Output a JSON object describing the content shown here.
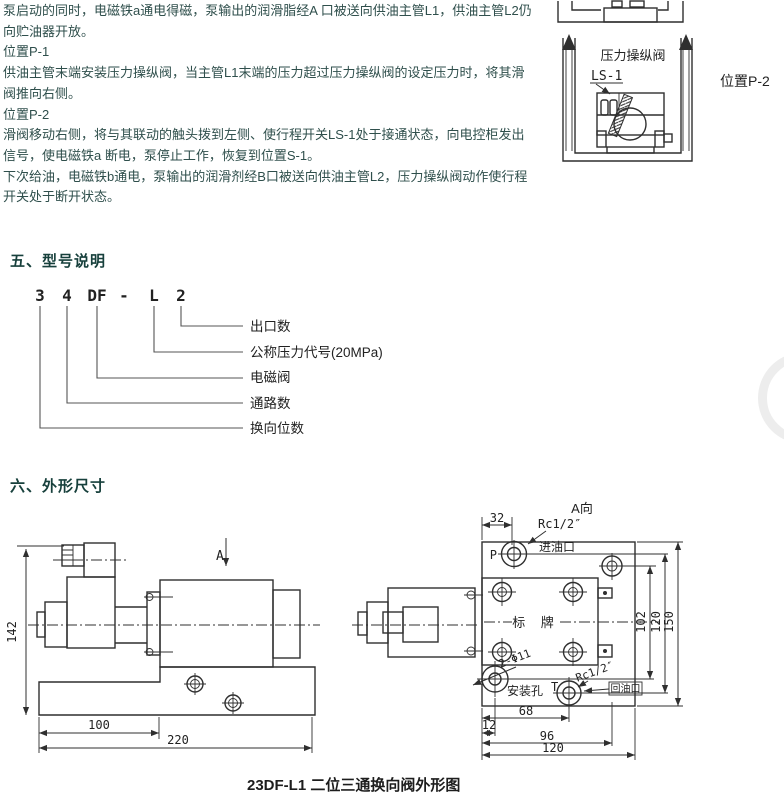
{
  "colors": {
    "text": "#2f4f4c",
    "heading": "#17403c",
    "drawing": "#2f2f2f",
    "background": "#ffffff"
  },
  "intro": {
    "lines": [
      "泵启动的同时，电磁铁a通电得磁，泵输出的润滑脂经A 口被送向供油主管L1，供油主管L2仍",
      "向贮油器开放。",
      "位置P-1",
      "供油主管末端安装压力操纵阀，当主管L1末端的压力超过压力操纵阀的设定压力时，将其滑",
      "阀推向右侧。",
      "位置P-2",
      "滑阀移动右侧，将与其联动的触头拨到左侧、使行程开关LS-1处于接通状态，向电控柜发出",
      "信号，使电磁铁a 断电，泵停止工作，恢复到位置S-1。",
      "下次给油，电磁铁b通电，泵输出的润滑剂经B口被送向供油主管L2，压力操纵阀动作使行程",
      "开关处于断开状态。"
    ]
  },
  "p2_diagram": {
    "valve_label": "压力操纵阀",
    "switch_label": "LS-1",
    "position_label": "位置P-2"
  },
  "model_section": {
    "heading": "五、型号说明",
    "code": [
      "3",
      "4",
      "DF",
      "-",
      "L",
      "2"
    ],
    "labels": [
      "出口数",
      "公称压力代号(20MPa)",
      "电磁阀",
      "通路数",
      "换向位数"
    ]
  },
  "outline_section": {
    "heading": "六、外形尺寸",
    "caption": "23DF-L1 二位三通换向阀外形图",
    "side_view": {
      "view_label": "A",
      "dim_height": "142",
      "dim_100": "100",
      "dim_220": "220"
    },
    "a_view": {
      "label": "A向",
      "dim_32": "32",
      "thread_p": "Rc1/2″",
      "port_p": "P",
      "inlet": "进油口",
      "nameplate": "标 牌",
      "holes": "2-Φ11",
      "mount_hole": "安装孔",
      "port_t": "T",
      "thread_t": "Rc1/2″",
      "outlet": "回油口",
      "dim_68": "68",
      "dim_12": "12",
      "dim_96": "96",
      "dim_120_bottom": "120",
      "dim_102": "102",
      "dim_120_right": "120",
      "dim_150": "150"
    }
  }
}
